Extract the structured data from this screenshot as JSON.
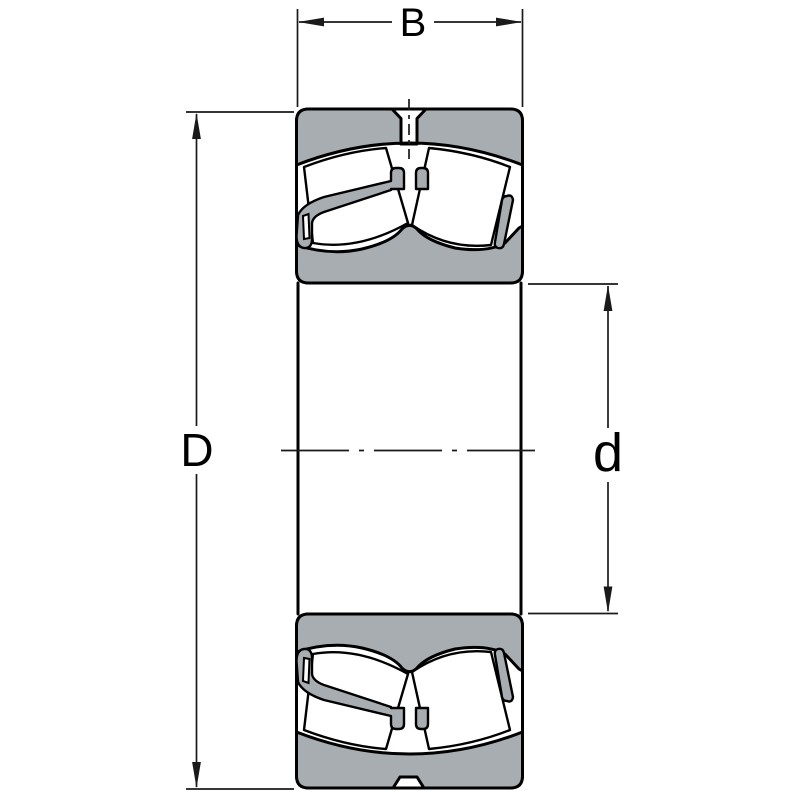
{
  "diagram": {
    "labels": {
      "width": "B",
      "outer_diameter": "D",
      "bore_diameter": "d"
    },
    "colors": {
      "ring_fill": "#a8adb1",
      "outline": "#000000",
      "dimension_lines": "#1a1a1a",
      "background": "#ffffff"
    }
  }
}
